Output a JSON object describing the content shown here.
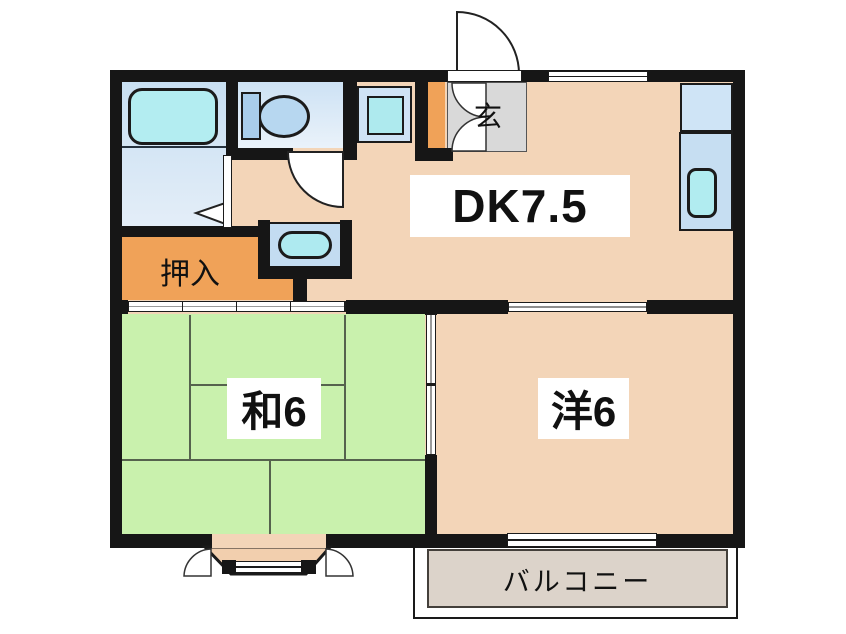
{
  "title": "Japanese apartment floor plan",
  "rooms": {
    "dk": {
      "label": "DK7.5",
      "type": "dining-kitchen",
      "size_mats": 7.5
    },
    "japanese_room": {
      "label": "和6",
      "type": "japanese-tatami-room",
      "size_mats": 6
    },
    "western_room": {
      "label": "洋6",
      "type": "western-room",
      "size_mats": 6
    },
    "closet": {
      "label": "押入",
      "type": "oshiire-closet"
    },
    "entrance": {
      "label": "玄",
      "type": "genkan-entrance"
    },
    "balcony": {
      "label": "バルコニー",
      "type": "balcony"
    }
  },
  "fixtures": [
    "bathtub-icon",
    "toilet-icon",
    "washbasin-icon",
    "washing-machine-space-icon",
    "kitchen-counter-icon",
    "kitchen-sink-icon",
    "shoe-cabinet-icon",
    "bay-window-icon",
    "entrance-door-arc-icon",
    "toilet-door-arc-icon",
    "sliding-door-icon",
    "window-icon"
  ],
  "colors": {
    "wall": "#161616",
    "floor_peach": "#f3d5b8",
    "bay_peach": "#f2cfae",
    "closet_orange": "#f0a258",
    "tatami_green": "#c9f1ad",
    "tatami_line": "#55624d",
    "genkan_gray": "#d9d9d9",
    "balcony_fill": "#dcd3ca",
    "bathtub_cyan": "#b3edf1",
    "toilet_blue": "#b7d7f0",
    "tank_blue": "#a9cdeb",
    "fixture_blue": "#c6def2",
    "sink_cyan": "#b1ecf0",
    "washer_outer": "#cfe3f5",
    "washer_inner": "#aeeaee",
    "basin_panel": "#c3dcf1",
    "basin_cyan": "#aeeaf0",
    "label_text": "#111111",
    "balcony_text": "#3a342e"
  }
}
